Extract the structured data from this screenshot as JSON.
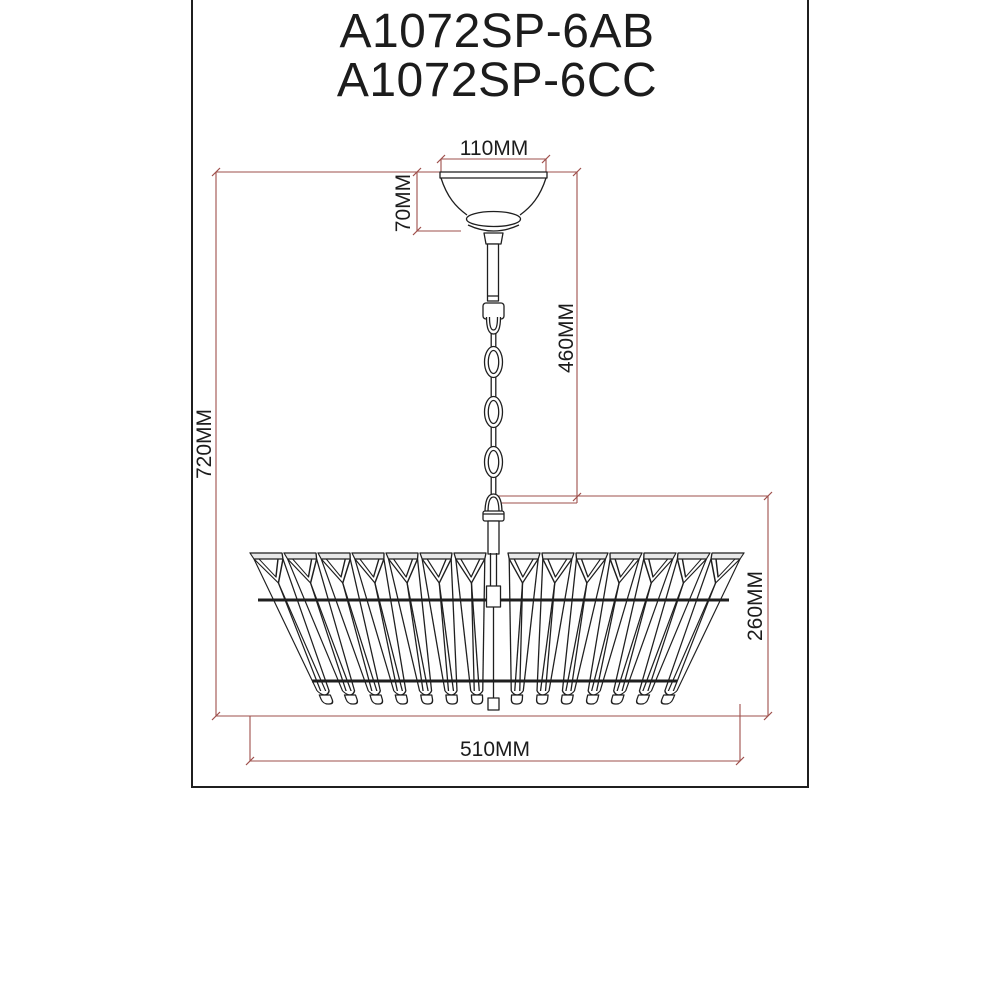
{
  "title": {
    "line1": "A1072SP-6AB",
    "line2": "A1072SP-6CC"
  },
  "dimensions": {
    "canopy_width": "110MM",
    "canopy_height": "70MM",
    "chain_length": "460MM",
    "overall_height": "720MM",
    "shade_height": "260MM",
    "shade_diameter": "510MM"
  },
  "colors": {
    "dimension_line": "#9e4f4b",
    "drawing_line": "#1f1f1f"
  }
}
